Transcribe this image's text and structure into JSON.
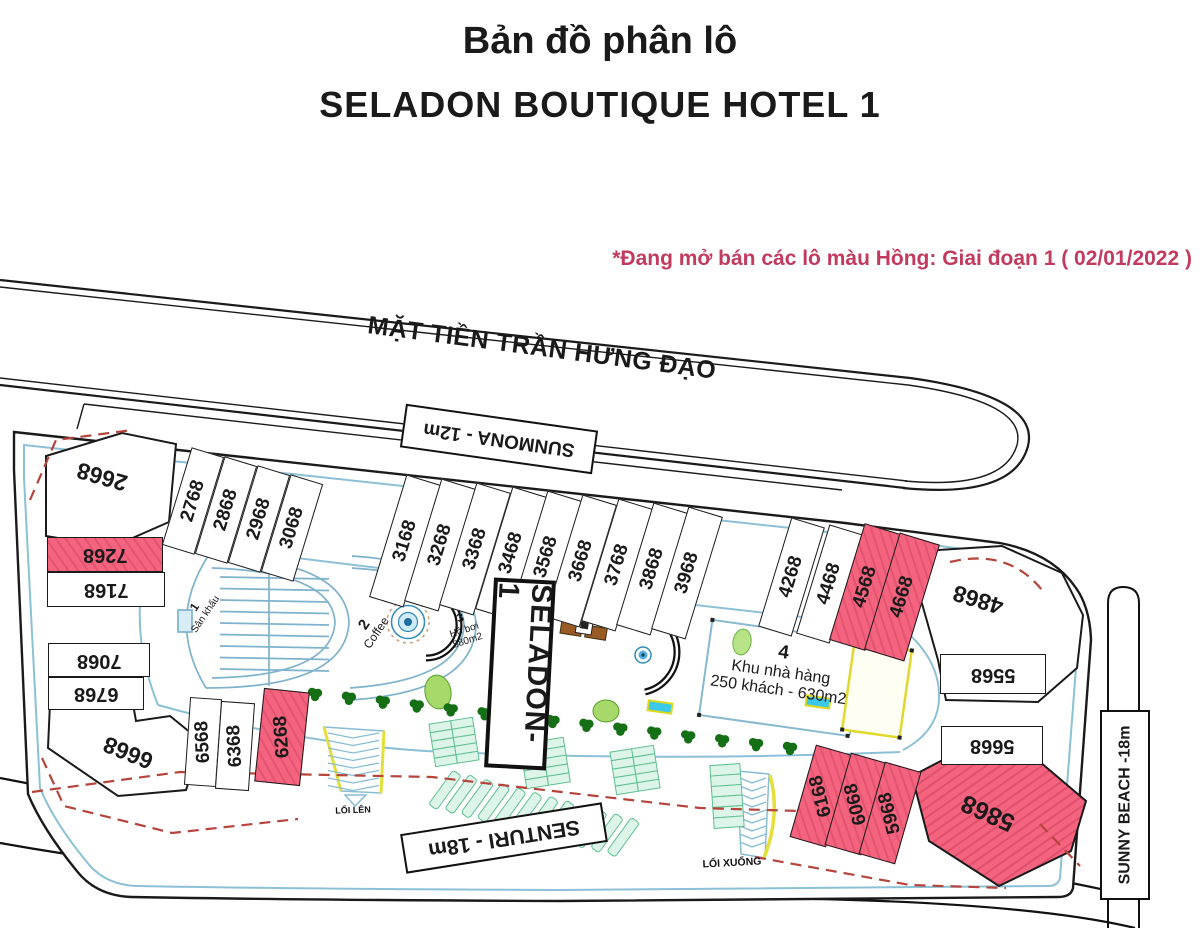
{
  "title": {
    "line1": "Bản đồ phân lô",
    "line2": "SELADON BOUTIQUE HOTEL 1"
  },
  "note": {
    "text": "*Đang mở bán các lô màu Hồng: Giai đoạn 1 ( 02/01/2022 )",
    "color": "#c23b5e"
  },
  "streets": {
    "main": "MẶT TIỀN TRẦN HƯNG ĐẠO",
    "sunmona": "SUNMONA - 12m",
    "senturi": "SENTURI - 18m",
    "sunny_beach": "SUNNY BEACH -18m"
  },
  "paths": {
    "loi_len": "LỐI LÊN",
    "loi_xuong": "LỐI XUỐNG"
  },
  "sign": {
    "label": "SELADON- 1"
  },
  "colors": {
    "pink_lot": "#f5647f",
    "note_red": "#c23b5e",
    "boundary_dash": "#b5443c"
  },
  "amenities": [
    {
      "num": "1",
      "name": "Sân khấu",
      "detail": "",
      "cx": 200,
      "cy": 618,
      "rot": -56,
      "ns": 12,
      "fs": 10
    },
    {
      "num": "2",
      "name": "Coffee",
      "detail": "",
      "cx": 370,
      "cy": 633,
      "rot": -56,
      "ns": 15,
      "fs": 12
    },
    {
      "num": "3",
      "name": "Hồ bơi",
      "detail": "880m2",
      "cx": 464,
      "cy": 641,
      "rot": -18,
      "ns": 12,
      "fs": 10
    },
    {
      "num": "4",
      "name": "Khu nhà hàng",
      "detail": "250 khách - 630m2",
      "cx": 781,
      "cy": 672,
      "rot": 8,
      "ns": 19,
      "fs": 16
    }
  ],
  "lots": [
    {
      "id": "2668",
      "cx": 102,
      "cy": 477,
      "labelOnly": true,
      "rot": 196,
      "fs": 23
    },
    {
      "id": "2768",
      "cx": 192,
      "cy": 500,
      "w": 32,
      "h": 100,
      "rot": 17,
      "tr": -90
    },
    {
      "id": "2868",
      "cx": 225,
      "cy": 509,
      "w": 32,
      "h": 100,
      "rot": 17,
      "tr": -90
    },
    {
      "id": "2968",
      "cx": 258,
      "cy": 518,
      "w": 32,
      "h": 100,
      "rot": 17,
      "tr": -90
    },
    {
      "id": "3068",
      "cx": 291,
      "cy": 527,
      "w": 32,
      "h": 100,
      "rot": 17,
      "tr": -90
    },
    {
      "id": "3168",
      "cx": 404,
      "cy": 540,
      "w": 34,
      "h": 126,
      "rot": 17,
      "tr": -90
    },
    {
      "id": "3268",
      "cx": 439,
      "cy": 544,
      "w": 34,
      "h": 126,
      "rot": 17,
      "tr": -90
    },
    {
      "id": "3368",
      "cx": 474,
      "cy": 548,
      "w": 34,
      "h": 126,
      "rot": 17,
      "tr": -90
    },
    {
      "id": "3468",
      "cx": 510,
      "cy": 552,
      "w": 34,
      "h": 126,
      "rot": 17,
      "tr": -90
    },
    {
      "id": "3568",
      "cx": 545,
      "cy": 556,
      "w": 34,
      "h": 126,
      "rot": 17,
      "tr": -90
    },
    {
      "id": "3668",
      "cx": 580,
      "cy": 560,
      "w": 34,
      "h": 126,
      "rot": 17,
      "tr": -90
    },
    {
      "id": "3768",
      "cx": 616,
      "cy": 564,
      "w": 34,
      "h": 126,
      "rot": 17,
      "tr": -90
    },
    {
      "id": "3868",
      "cx": 651,
      "cy": 568,
      "w": 34,
      "h": 126,
      "rot": 17,
      "tr": -90
    },
    {
      "id": "3968",
      "cx": 686,
      "cy": 572,
      "w": 34,
      "h": 126,
      "rot": 17,
      "tr": -90
    },
    {
      "id": "4268",
      "cx": 790,
      "cy": 576,
      "w": 33,
      "h": 112,
      "rot": 17,
      "tr": -90
    },
    {
      "id": "4468",
      "cx": 828,
      "cy": 583,
      "w": 33,
      "h": 112,
      "rot": 17,
      "tr": -90
    },
    {
      "id": "4568",
      "cx": 864,
      "cy": 586,
      "w": 36,
      "h": 120,
      "rot": 17,
      "tr": -90,
      "pink": true
    },
    {
      "id": "4668",
      "cx": 901,
      "cy": 596,
      "w": 40,
      "h": 120,
      "rot": 17,
      "tr": -90,
      "pink": true
    },
    {
      "id": "4868",
      "cx": 978,
      "cy": 600,
      "labelOnly": true,
      "rot": 197,
      "fs": 23
    },
    {
      "id": "5568",
      "cx": 992,
      "cy": 673,
      "w": 104,
      "h": 38,
      "rot": 0,
      "tr": 180,
      "bar": true
    },
    {
      "id": "5668",
      "cx": 991,
      "cy": 744,
      "w": 100,
      "h": 37,
      "rot": 0,
      "tr": 180,
      "bar": true
    },
    {
      "id": "7268",
      "cx": 104,
      "cy": 553,
      "w": 114,
      "h": 33,
      "rot": 0,
      "tr": 180,
      "bar": true,
      "pink": true
    },
    {
      "id": "7168",
      "cx": 105,
      "cy": 588,
      "w": 116,
      "h": 33,
      "rot": 0,
      "tr": 180,
      "bar": true
    },
    {
      "id": "7068",
      "cx": 98,
      "cy": 659,
      "w": 100,
      "h": 32,
      "rot": 0,
      "tr": 180,
      "bar": true
    },
    {
      "id": "6768",
      "cx": 95,
      "cy": 692,
      "w": 94,
      "h": 31,
      "rot": 0,
      "tr": 180,
      "bar": true
    },
    {
      "id": "6668",
      "cx": 128,
      "cy": 753,
      "labelOnly": true,
      "rot": 202,
      "fs": 23
    },
    {
      "id": "6568",
      "cx": 202,
      "cy": 741,
      "w": 30,
      "h": 86,
      "rot": 4,
      "tr": -97
    },
    {
      "id": "6368",
      "cx": 234,
      "cy": 745,
      "w": 32,
      "h": 86,
      "rot": 4,
      "tr": -97
    },
    {
      "id": "6268",
      "cx": 281,
      "cy": 736,
      "w": 44,
      "h": 92,
      "rot": 6,
      "tr": -100,
      "pink": true
    },
    {
      "id": "6168",
      "cx": 820,
      "cy": 795,
      "w": 36,
      "h": 94,
      "rot": 16,
      "tr": -120,
      "pink": true
    },
    {
      "id": "6068",
      "cx": 855,
      "cy": 803,
      "w": 36,
      "h": 94,
      "rot": 16,
      "tr": -120,
      "pink": true
    },
    {
      "id": "5968",
      "cx": 889,
      "cy": 812,
      "w": 36,
      "h": 94,
      "rot": 16,
      "tr": -120,
      "pink": true
    },
    {
      "id": "5868",
      "cx": 988,
      "cy": 813,
      "labelOnly": true,
      "rot": 204,
      "fs": 25
    }
  ]
}
